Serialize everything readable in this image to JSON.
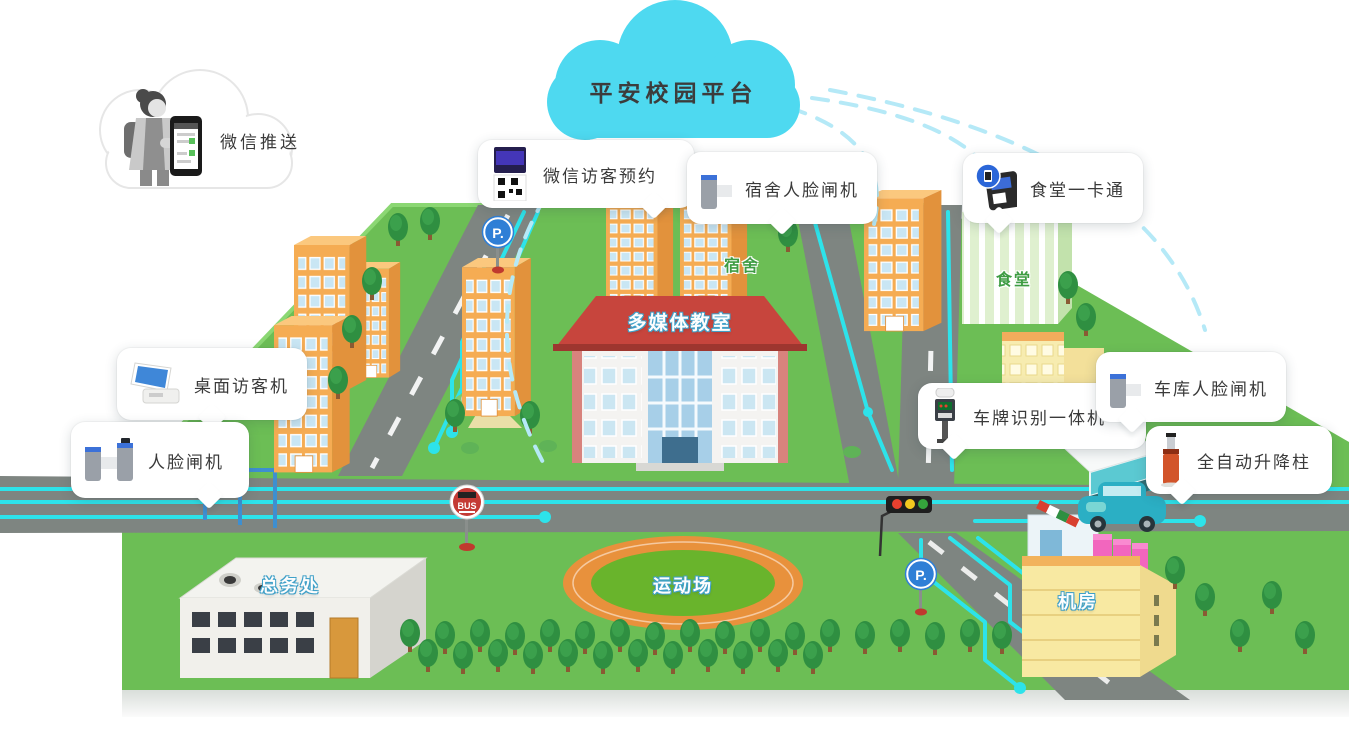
{
  "title": "平安校园平台",
  "wechat_push": {
    "label": "微信推送"
  },
  "callouts": {
    "visitor_appointment": {
      "label": "微信访客预约"
    },
    "dorm_face_gate": {
      "label": "宿舍人脸闸机"
    },
    "canteen_card": {
      "label": "食堂一卡通"
    },
    "desktop_visitor": {
      "label": "桌面访客机"
    },
    "face_gate": {
      "label": "人脸闸机"
    },
    "lpr_machine": {
      "label": "车牌识别一体机"
    },
    "garage_face_gate": {
      "label": "车库人脸闸机"
    },
    "bollard": {
      "label": "全自动升降柱"
    }
  },
  "map_labels": {
    "dorm": "宿舍",
    "canteen": "食堂",
    "multimedia_classroom": "多媒体教室",
    "general_affairs_office": "总务处",
    "sports_field": "运动场",
    "machine_room": "机房"
  },
  "signs": {
    "bus": "BUS",
    "parking": "P."
  },
  "colors": {
    "cloud": "#4ED9F0",
    "circuit": "#2DE3EA",
    "dashed_link": "#B5E9F7",
    "grass": "#6CBE55",
    "road": "#7E8581",
    "building_orange": "#F5AC53",
    "roof_red": "#C7453D",
    "track_orange": "#E8913C",
    "field_green": "#69B42C",
    "canteen_green": "#DFF0CF",
    "machine_pink": "#F266BE",
    "car_teal": "#2BAFC4"
  }
}
